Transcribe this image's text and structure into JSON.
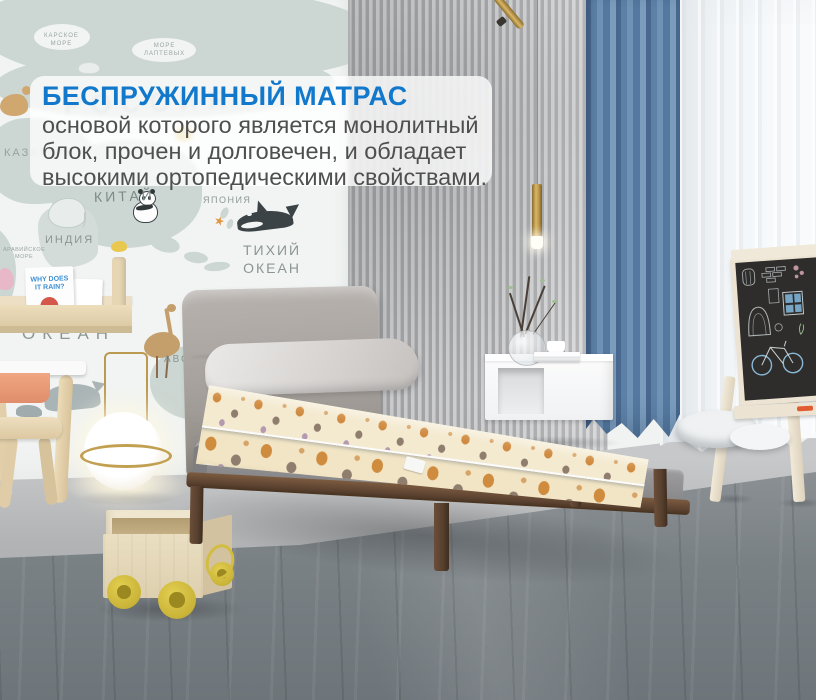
{
  "overlay": {
    "title": "БЕСПРУЖИННЫЙ МАТРАС",
    "line1": "основой которого является монолитный",
    "line2": "блок, прочен и долговечен, и обладает",
    "line3": "высокими ортопедическими свойствами.",
    "title_color": "#1278cc",
    "body_color": "#4f4f4f",
    "background": "rgba(255,255,255,0.78)"
  },
  "map": {
    "labels": {
      "russia": "РОССИЯ",
      "karskoe_sea": "КАРСКОЕ\nМОРЕ",
      "laptev_sea": "МОРЕ\nЛАПТЕВЫХ",
      "kazakhstan": "КАЗАХСТАН",
      "china": "КИТАЙ",
      "japan": "ЯПОНИЯ",
      "india": "ИНДИЯ",
      "arabian_sea": "АРАВИЙСКОЕ\nМОРЕ",
      "pacific_ocean": "ТИХИЙ\nОКЕАН",
      "indian_ocean_top": "ИНДИЙСКИЙ",
      "indian_ocean_bottom": "ОКЕАН",
      "australia": "АВСТРАЛИЯ"
    },
    "book_title": "WHY DOES\nIT RAIN?",
    "icons": {
      "starfish_glyph": "★"
    }
  },
  "palette": {
    "accent_blue_text": "#1278cc",
    "curtain_blue": "#5d80a6",
    "mattress_cream": "#f1e5c5",
    "mattress_print_orange": "#cf8c3f",
    "wood_frame": "#5a4130",
    "brass_gold": "#c2a052",
    "floor_dark": "#757c80",
    "map_land": "#ccd6d2"
  }
}
